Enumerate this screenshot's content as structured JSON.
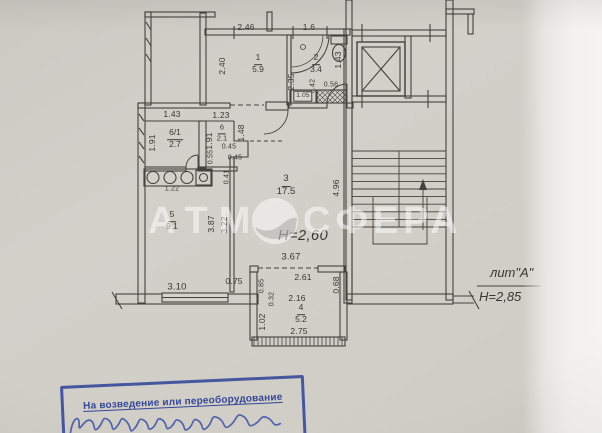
{
  "watermark": {
    "left": "АТМ",
    "right": "СФЕРА"
  },
  "rooms": {
    "r1": {
      "num": "1",
      "area": "5.9"
    },
    "r2": {
      "num": "2",
      "area": "3.4"
    },
    "r3": {
      "num": "3",
      "area": "17.5"
    },
    "r4": {
      "num": "4",
      "area": "5.2"
    },
    "r5": {
      "num": "5",
      "area": "9.1"
    },
    "r6": {
      "num": "6",
      "area": "2.1"
    },
    "r61": {
      "num": "6/1",
      "area": "2.7"
    }
  },
  "dims": {
    "d246": "2.46",
    "d240": "2.40",
    "d16": "1.6",
    "d235": "2.35",
    "d143b": "1.43",
    "d042": "0.42",
    "d056": "0.56",
    "d105": "1.05",
    "d143": "1.43",
    "d123": "1.23",
    "d191a": "1.91",
    "d191b": "1.91",
    "d148": "1.48",
    "d045a": "0.45",
    "d055": "0.55",
    "d045b": "0.45",
    "d041": "0.41",
    "d122": "1.22",
    "d496": "4.96",
    "d367": "3.67",
    "d387": "3.87",
    "d322": "3.22",
    "d310": "3.10",
    "d075": "0.75",
    "d085": "0.85",
    "d261": "2.61",
    "d068": "0.68",
    "d216": "2.16",
    "d032": "0.32",
    "d102": "1.02",
    "d275": "2.75"
  },
  "notes": {
    "height_inner": "Н=2,60",
    "liter": "лит\"А\"",
    "height_outer": "Н=2,85"
  },
  "stamp": {
    "line1": "На возведение или переоборудование"
  }
}
